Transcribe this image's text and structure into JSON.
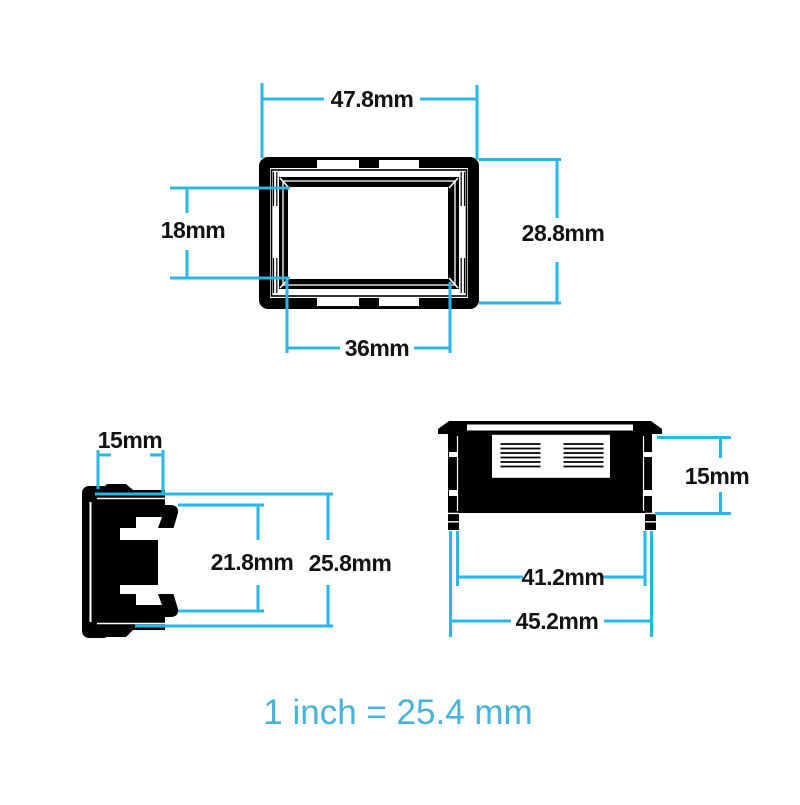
{
  "drawing": {
    "description": "Dimensional drawing of a digital panel meter housing shown in three views",
    "unit": "mm",
    "colors": {
      "dimension_line": "#29b6ea",
      "dimension_text": "#131313",
      "part": "#000000",
      "background": "#ffffff",
      "caption": "#47b2de"
    },
    "views": {
      "front": {
        "name": "front-view",
        "dims": {
          "outer_width": "47.8mm",
          "outer_height": "28.8mm",
          "window_height": "18mm",
          "window_width": "36mm"
        }
      },
      "side": {
        "name": "side-view",
        "dims": {
          "depth": "15mm",
          "clip_opening": "21.8mm",
          "overall_height": "25.8mm"
        }
      },
      "top": {
        "name": "top-view",
        "dims": {
          "depth": "15mm",
          "snap_width": "41.2mm",
          "overall_width": "45.2mm"
        }
      }
    },
    "caption": "1 inch = 25.4 mm"
  }
}
